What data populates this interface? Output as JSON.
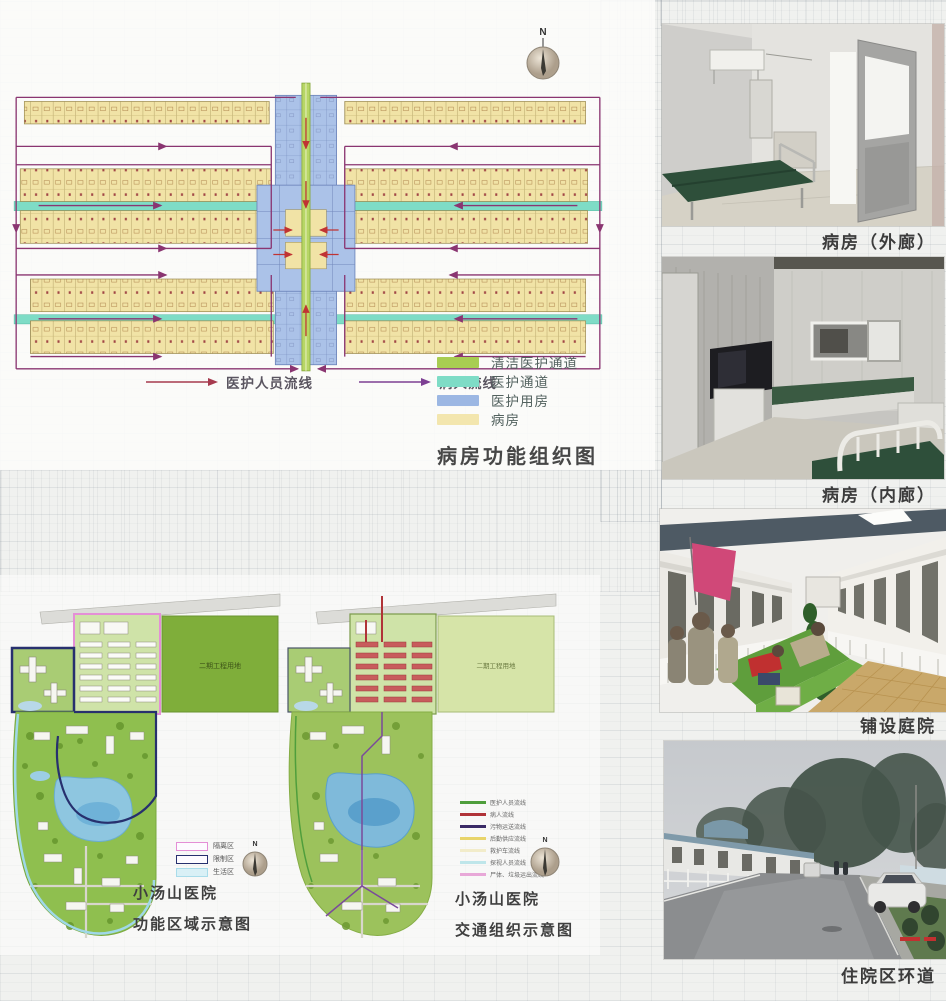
{
  "floor_plan_panel": {
    "title": "病房功能组织图",
    "compass_label": "N",
    "flow_legend": [
      {
        "label": "医护人员流线",
        "color": "#a63a4e"
      },
      {
        "label": "病人流线",
        "color": "#7d3f93"
      }
    ],
    "area_legend": [
      {
        "label": "清洁医护通道",
        "color": "#a8cd52"
      },
      {
        "label": "医护通道",
        "color": "#7edcc6"
      },
      {
        "label": "医护用房",
        "color": "#9cb7e3"
      },
      {
        "label": "病房",
        "color": "#f3e6ae"
      }
    ]
  },
  "site_plans": [
    {
      "caption_line1": "小汤山医院",
      "caption_line2": "功能区域示意图",
      "area_label": "二期工程用地",
      "compass_label": "N",
      "legend": [
        {
          "label": "隔离区",
          "color": "#e48fd6"
        },
        {
          "label": "限制区",
          "color": "#27306e"
        },
        {
          "label": "生活区",
          "color": "#a9dcea"
        }
      ]
    },
    {
      "caption_line1": "小汤山医院",
      "caption_line2": "交通组织示意图",
      "area_label": "二期工程用地",
      "compass_label": "N",
      "legend": [
        {
          "label": "医护人员流线",
          "color": "#4f9e3c"
        },
        {
          "label": "病人流线",
          "color": "#b03338"
        },
        {
          "label": "污物运送流线",
          "color": "#3a2a66"
        },
        {
          "label": "后勤供应流线",
          "color": "#e8d46a"
        },
        {
          "label": "救护车流线",
          "color": "#f2ecca"
        },
        {
          "label": "探视人员流线",
          "color": "#bfe6ea"
        },
        {
          "label": "尸体、垃圾运出流线",
          "color": "#e8a8d8"
        }
      ]
    }
  ],
  "photos": [
    {
      "caption": "病房（外廊）"
    },
    {
      "caption": "病房（内廊）"
    },
    {
      "caption": "铺设庭院"
    },
    {
      "caption": "住院区环道"
    }
  ]
}
